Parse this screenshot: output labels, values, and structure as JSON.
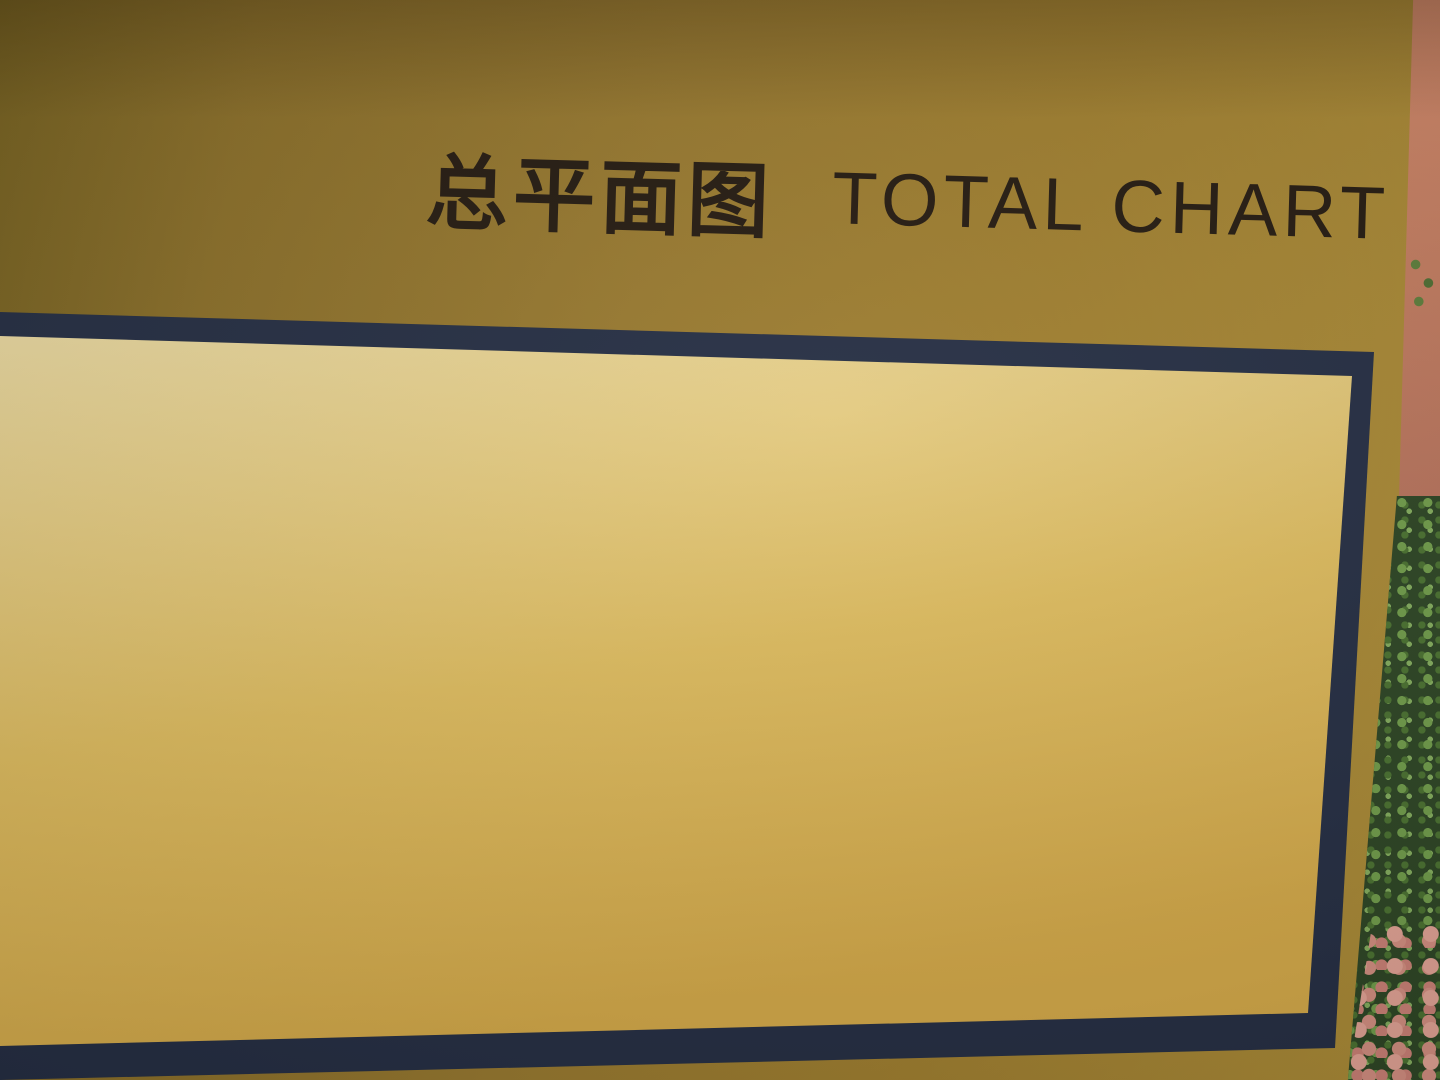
{
  "title": {
    "zh": "总平面图",
    "en": "TOTAL CHART"
  },
  "watermark": "青岛旭日装饰工程有限公司",
  "legend": {
    "heading": "图例",
    "items": [
      {
        "key": "FL",
        "label": "完成面标高"
      },
      {
        "key": "TC",
        "label": "牙石标高"
      },
      {
        "key": "TW",
        "label": "墙顶标高"
      },
      {
        "key": "TS",
        "label": "覆土完成标高"
      },
      {
        "key": "◄—",
        "label": "坡度"
      }
    ]
  },
  "map": {
    "buildings": [
      {
        "label": "1#",
        "x": 75,
        "y": 967
      },
      {
        "label": "2#",
        "x": 163,
        "y": 973
      },
      {
        "label": "3#",
        "x": 269,
        "y": 973
      },
      {
        "label": "4#",
        "x": 359,
        "y": 962
      },
      {
        "label": "5#",
        "x": 459,
        "y": 907
      },
      {
        "label": "6#",
        "x": 545,
        "y": 901
      },
      {
        "label": "7#",
        "x": 653,
        "y": 890
      },
      {
        "label": "8#",
        "x": 740,
        "y": 886
      },
      {
        "label": "9#",
        "x": 821,
        "y": 882
      },
      {
        "label": "10#",
        "x": 903,
        "y": 875
      },
      {
        "label": "11#",
        "x": 99,
        "y": 890
      },
      {
        "label": "12#",
        "x": 201,
        "y": 892
      },
      {
        "label": "13#",
        "x": 328,
        "y": 889
      },
      {
        "label": "14#",
        "x": 126,
        "y": 807
      },
      {
        "label": "15#",
        "x": 265,
        "y": 819
      },
      {
        "label": "16#",
        "x": 437,
        "y": 817
      },
      {
        "label": "17#",
        "x": 529,
        "y": 828
      },
      {
        "label": "18#",
        "x": 616,
        "y": 797
      },
      {
        "label": "19#",
        "x": 717,
        "y": 813
      },
      {
        "label": "20#",
        "x": 805,
        "y": 809
      },
      {
        "label": "21#",
        "x": 896,
        "y": 804
      },
      {
        "label": "22#",
        "x": 142,
        "y": 739
      },
      {
        "label": "23#",
        "x": 242,
        "y": 737
      },
      {
        "label": "24#",
        "x": 364,
        "y": 740
      },
      {
        "label": "25#",
        "x": 448,
        "y": 738
      },
      {
        "label": "26#",
        "x": 542,
        "y": 733
      },
      {
        "label": "27#",
        "x": 634,
        "y": 731
      },
      {
        "label": "28#",
        "x": 729,
        "y": 730
      },
      {
        "label": "29#",
        "x": 817,
        "y": 728
      },
      {
        "label": "30#",
        "x": 907,
        "y": 725
      },
      {
        "label": "31#",
        "x": 549,
        "y": 634
      },
      {
        "label": "32#",
        "x": 640,
        "y": 633
      },
      {
        "label": "33#",
        "x": 753,
        "y": 656
      },
      {
        "label": "34#",
        "x": 954,
        "y": 649
      },
      {
        "label": "35#",
        "x": 1033,
        "y": 635
      },
      {
        "label": "36#",
        "x": 1119,
        "y": 615
      },
      {
        "label": "37#",
        "x": 724,
        "y": 588
      },
      {
        "label": "38#",
        "x": 838,
        "y": 587
      },
      {
        "label": "39#",
        "x": 929,
        "y": 572
      },
      {
        "label": "40#",
        "x": 1013,
        "y": 554
      },
      {
        "label": "41#",
        "x": 1103,
        "y": 535
      },
      {
        "label": "42#",
        "x": 1190,
        "y": 515
      },
      {
        "label": "43#",
        "x": 545,
        "y": 548
      },
      {
        "label": "44#",
        "x": 640,
        "y": 540
      },
      {
        "label": "45#",
        "x": 732,
        "y": 530
      },
      {
        "label": "46#",
        "x": 825,
        "y": 514
      },
      {
        "label": "47#",
        "x": 914,
        "y": 496
      },
      {
        "label": "48#",
        "x": 995,
        "y": 478
      },
      {
        "label": "49#",
        "x": 1077,
        "y": 463
      },
      {
        "label": "50#",
        "x": 1154,
        "y": 449
      }
    ]
  },
  "colors": {
    "board_gold": "#97782e",
    "frame_navy": "#242d42",
    "frame_trim_gold": "#d9b452",
    "map_paper": "#f8f6f1",
    "marker_navy": "#232e5c",
    "road_gray": "#98979d",
    "green_band": "#d6e5b8",
    "tree_green": "#2e5140",
    "school_salmon": "#d5a183",
    "pool_blue": "#84b6da",
    "wall_terracotta": "#c87f63",
    "foliage_green": "#2c4423",
    "foliage_pink": "#dd9b8e"
  }
}
